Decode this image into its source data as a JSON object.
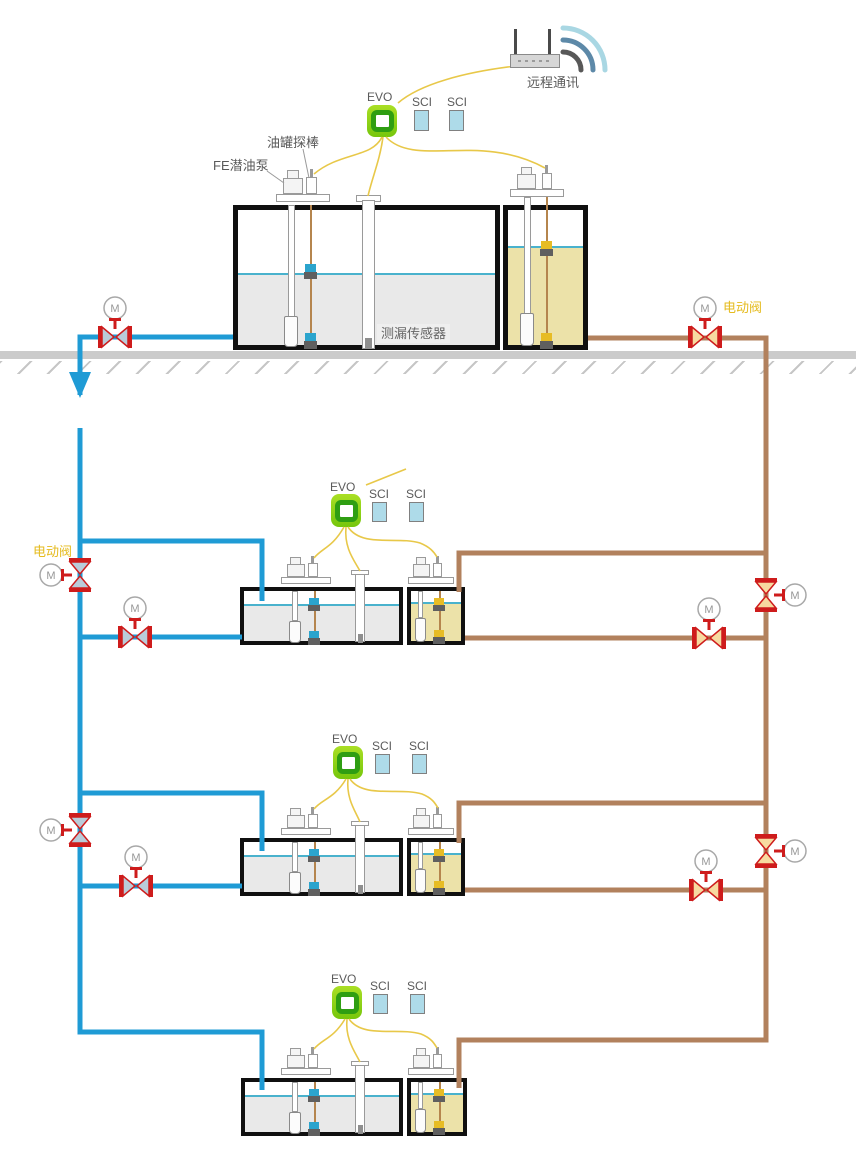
{
  "diagram": {
    "remote_comm_label": "远程通讯",
    "motor_label": "M",
    "stations": [
      {
        "evo_label": "EVO",
        "sci1_label": "SCI",
        "sci2_label": "SCI",
        "tank_label": "0#",
        "probe_callout": "油罐探棒",
        "pump_callout": "FE潜油泵",
        "leak_sensor_callout": "测漏传感器",
        "electric_valve_label": "电动阀"
      },
      {
        "evo_label": "EVO",
        "sci1_label": "SCI",
        "sci2_label": "SCI",
        "tank_label": "0#",
        "electric_valve_label": "电动阀"
      },
      {
        "evo_label": "EVO",
        "sci1_label": "SCI",
        "sci2_label": "SCI",
        "tank_label": "0#"
      },
      {
        "evo_label": "EVO",
        "sci1_label": "SCI",
        "sci2_label": "SCI",
        "tank_label": "0#"
      }
    ],
    "colors": {
      "supply_pipe_blue": "#1F9BD5",
      "return_pipe_brown": "#B2815D",
      "valve_red": "#CE1C1C",
      "evo_green": "#7AC80E",
      "sci_blue": "#AEDBE9",
      "signal_wire_yellow": "#E8C849",
      "oil_fill_khaki": "#ECE2A9",
      "water_fill_gray": "#E9E9E9",
      "liquid_line_teal": "#49B2CD",
      "tank_label_orange": "#C4774D",
      "electric_valve_label_gold": "#E5BB1E"
    }
  }
}
